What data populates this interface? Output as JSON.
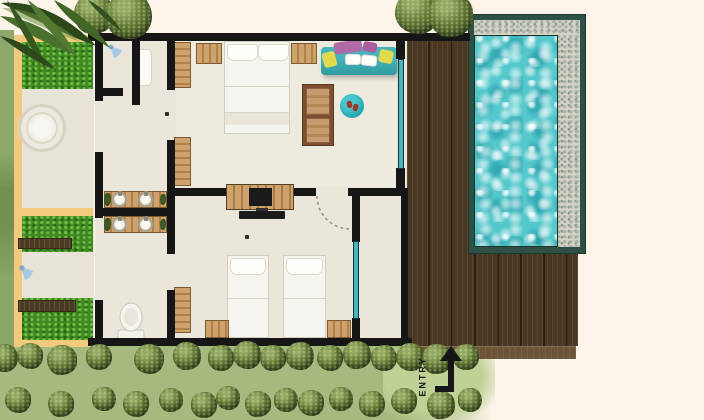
{
  "scene": {
    "description": "Top-view floor plan of a one-bedroom pool villa with garden courtyard, outdoor bathroom, timber deck and plunge pool",
    "entry": {
      "label": "ENTRY"
    }
  },
  "icons": {
    "entry_arrow": "up-arrow-L-shaped",
    "outdoor_shower": "spray-fan",
    "indoor_shower": "spray-fan",
    "toilet": "toilet-top-view",
    "soaking_tub": "round-tub-top-view",
    "door_swing": "dashed-quarter-arc"
  },
  "palette": {
    "background": "#fcf3e9",
    "wall": "#161616",
    "lawn": "#a6ba80",
    "entry_path": "#c0d195",
    "tree_green": "#5f7536",
    "palm_green": "#2d491b",
    "garden_strip": "#8aa668",
    "fence_tan": "#f2ca7e",
    "grass": "#3f8a23",
    "courtyard_stone": "#e7e4d7",
    "floor": "#eae6da",
    "wood_light": "#cda26c",
    "wood_red": "#b68757",
    "deck_brown": "#4a3722",
    "deck_step": "#6b5438",
    "pool_frame": "#2e5045",
    "pebble": "#d6d3c8",
    "water": "#55c8cc",
    "glass_teal": "#45b5c2",
    "sofa_teal": "#37a6ab",
    "rug_teal": "#24a7b4",
    "pillow_purple": "#b06aa8",
    "pillow_yellow": "#e3d94e",
    "linen_white": "#f7f6f1"
  },
  "features": {
    "pool": "plunge-pool",
    "deck": "timber-deck",
    "courtyard": "outdoor-bathroom-garden",
    "beds": [
      "double-bed",
      "twin-bed",
      "twin-bed"
    ],
    "vanity_sinks": 4,
    "sofa": "daybed-sofa",
    "tv": "wall-tv-console"
  }
}
